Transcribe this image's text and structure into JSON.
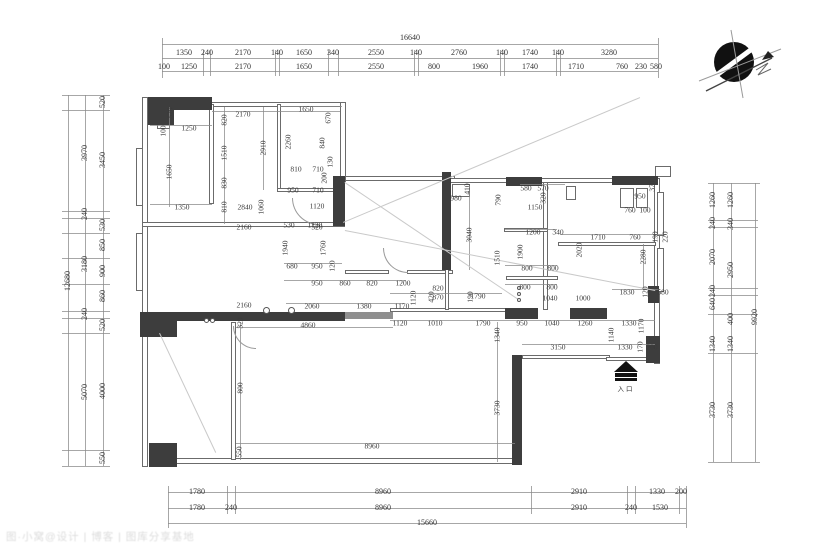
{
  "title": "户型平面图",
  "entrance": {
    "label": "入口"
  },
  "watermark": {
    "text": "图·小窝@设计 | 博客 | 图库分享基地"
  },
  "colors": {
    "wall_dark": "#3d3d3d",
    "wall_gray": "#8f8f8f",
    "line": "#8a8a8a",
    "text": "#3a3a3a",
    "compass": "#111111"
  },
  "icons": [
    "north-compass-icon",
    "entrance-arrow-icon"
  ],
  "exterior_dims": [
    [
      "16640",
      410,
      38,
      0
    ],
    [
      "1350",
      184,
      53,
      0
    ],
    [
      "240",
      207,
      53,
      0
    ],
    [
      "2170",
      243,
      53,
      0
    ],
    [
      "140",
      277,
      53,
      0
    ],
    [
      "1650",
      304,
      53,
      0
    ],
    [
      "340",
      333,
      53,
      0
    ],
    [
      "2550",
      376,
      53,
      0
    ],
    [
      "140",
      416,
      53,
      0
    ],
    [
      "2760",
      459,
      53,
      0
    ],
    [
      "140",
      502,
      53,
      0
    ],
    [
      "1740",
      530,
      53,
      0
    ],
    [
      "140",
      558,
      53,
      0
    ],
    [
      "3280",
      609,
      53,
      0
    ],
    [
      "100",
      164,
      67,
      0
    ],
    [
      "1250",
      189,
      67,
      0
    ],
    [
      "2170",
      243,
      67,
      0
    ],
    [
      "1650",
      304,
      67,
      0
    ],
    [
      "2550",
      376,
      67,
      0
    ],
    [
      "800",
      434,
      67,
      0
    ],
    [
      "1960",
      480,
      67,
      0
    ],
    [
      "1740",
      530,
      67,
      0
    ],
    [
      "1710",
      576,
      67,
      0
    ],
    [
      "760",
      622,
      67,
      0
    ],
    [
      "230",
      641,
      67,
      0
    ],
    [
      "580",
      656,
      67,
      0
    ],
    [
      "1780",
      197,
      492,
      0
    ],
    [
      "8960",
      383,
      492,
      0
    ],
    [
      "2910",
      579,
      492,
      0
    ],
    [
      "1330",
      657,
      492,
      0
    ],
    [
      "200",
      681,
      492,
      0
    ],
    [
      "1780",
      197,
      508,
      0
    ],
    [
      "240",
      231,
      508,
      0
    ],
    [
      "8960",
      383,
      508,
      0
    ],
    [
      "2910",
      579,
      508,
      0
    ],
    [
      "240",
      631,
      508,
      0
    ],
    [
      "1530",
      660,
      508,
      0
    ],
    [
      "15660",
      427,
      523,
      0
    ],
    [
      "12680",
      68,
      281,
      1
    ],
    [
      "3970",
      85,
      153,
      1
    ],
    [
      "240",
      85,
      214,
      1
    ],
    [
      "3180",
      85,
      264,
      1
    ],
    [
      "240",
      85,
      314,
      1
    ],
    [
      "5070",
      85,
      392,
      1
    ],
    [
      "520",
      103,
      102,
      1
    ],
    [
      "3450",
      103,
      160,
      1
    ],
    [
      "530",
      103,
      225,
      1
    ],
    [
      "850",
      103,
      245,
      1
    ],
    [
      "900",
      103,
      271,
      1
    ],
    [
      "860",
      103,
      296,
      1
    ],
    [
      "520",
      103,
      325,
      1
    ],
    [
      "4000",
      103,
      391,
      1
    ],
    [
      "550",
      103,
      458,
      1
    ],
    [
      "1260",
      713,
      200,
      1
    ],
    [
      "240",
      713,
      223,
      1
    ],
    [
      "2070",
      713,
      257,
      1
    ],
    [
      "240",
      713,
      291,
      1
    ],
    [
      "640",
      713,
      304,
      1
    ],
    [
      "1340",
      713,
      344,
      1
    ],
    [
      "3730",
      713,
      410,
      1
    ],
    [
      "1260",
      731,
      200,
      1
    ],
    [
      "340",
      731,
      224,
      1
    ],
    [
      "2950",
      731,
      270,
      1
    ],
    [
      "400",
      731,
      319,
      1
    ],
    [
      "1340",
      731,
      344,
      1
    ],
    [
      "3730",
      731,
      410,
      1
    ],
    [
      "9920",
      755,
      317,
      1
    ]
  ],
  "interior_dims": [
    [
      "520",
      170,
      113,
      1
    ],
    [
      "100",
      163,
      131,
      1
    ],
    [
      "1250",
      189,
      128,
      0
    ],
    [
      "1650",
      169,
      172,
      1
    ],
    [
      "1350",
      182,
      207,
      0
    ],
    [
      "2170",
      243,
      114,
      0
    ],
    [
      "820",
      224,
      120,
      1
    ],
    [
      "1510",
      224,
      153,
      1
    ],
    [
      "830",
      224,
      183,
      1
    ],
    [
      "810",
      224,
      207,
      1
    ],
    [
      "2910",
      263,
      148,
      1
    ],
    [
      "2840",
      245,
      207,
      0
    ],
    [
      "1060",
      261,
      207,
      1
    ],
    [
      "1650",
      306,
      109,
      0
    ],
    [
      "670",
      328,
      118,
      1
    ],
    [
      "2260",
      288,
      142,
      1
    ],
    [
      "840",
      322,
      143,
      1
    ],
    [
      "810",
      296,
      169,
      0
    ],
    [
      "710",
      318,
      169,
      0
    ],
    [
      "130",
      330,
      162,
      1
    ],
    [
      "200",
      324,
      178,
      1
    ],
    [
      "950",
      293,
      190,
      0
    ],
    [
      "710",
      318,
      190,
      0
    ],
    [
      "1120",
      317,
      206,
      0
    ],
    [
      "530",
      289,
      225,
      0
    ],
    [
      "1120",
      315,
      225,
      0
    ],
    [
      "2160",
      244,
      227,
      0
    ],
    [
      "520",
      317,
      227,
      0
    ],
    [
      "1940",
      285,
      248,
      1
    ],
    [
      "1760",
      323,
      248,
      1
    ],
    [
      "680",
      292,
      266,
      0
    ],
    [
      "950",
      317,
      266,
      0
    ],
    [
      "120",
      332,
      266,
      1
    ],
    [
      "950",
      317,
      283,
      0
    ],
    [
      "860",
      345,
      283,
      0
    ],
    [
      "820",
      372,
      283,
      0
    ],
    [
      "1200",
      403,
      283,
      0
    ],
    [
      "820",
      438,
      288,
      0
    ],
    [
      "870",
      438,
      297,
      0
    ],
    [
      "1120",
      413,
      298,
      1
    ],
    [
      "2060",
      312,
      306,
      0
    ],
    [
      "1380",
      364,
      306,
      0
    ],
    [
      "1170",
      402,
      306,
      0
    ],
    [
      "2160",
      244,
      305,
      0
    ],
    [
      "320",
      240,
      323,
      1
    ],
    [
      "4860",
      308,
      325,
      0
    ],
    [
      "800",
      240,
      388,
      1
    ],
    [
      "550",
      239,
      452,
      1
    ],
    [
      "8960",
      372,
      446,
      0
    ],
    [
      "980",
      456,
      198,
      0
    ],
    [
      "410",
      467,
      189,
      1
    ],
    [
      "3040",
      469,
      235,
      1
    ],
    [
      "790",
      498,
      200,
      1
    ],
    [
      "580",
      526,
      188,
      0
    ],
    [
      "570",
      543,
      188,
      0
    ],
    [
      "320",
      543,
      198,
      1
    ],
    [
      "1150",
      535,
      207,
      0
    ],
    [
      "1200",
      533,
      232,
      0
    ],
    [
      "340",
      558,
      232,
      0
    ],
    [
      "1900",
      520,
      252,
      1
    ],
    [
      "2020",
      579,
      250,
      1
    ],
    [
      "800",
      527,
      268,
      0
    ],
    [
      "800",
      553,
      268,
      0
    ],
    [
      "1510",
      497,
      258,
      1
    ],
    [
      "800",
      525,
      287,
      0
    ],
    [
      "800",
      552,
      287,
      0
    ],
    [
      "190",
      470,
      297,
      1
    ],
    [
      "420",
      431,
      297,
      1
    ],
    [
      "1790",
      478,
      296,
      0
    ],
    [
      "1040",
      550,
      298,
      0
    ],
    [
      "1000",
      583,
      298,
      0
    ],
    [
      "1710",
      598,
      237,
      0
    ],
    [
      "760",
      635,
      237,
      0
    ],
    [
      "190",
      655,
      237,
      1
    ],
    [
      "220",
      665,
      237,
      1
    ],
    [
      "950",
      640,
      196,
      0
    ],
    [
      "370",
      652,
      186,
      1
    ],
    [
      "760",
      630,
      210,
      0
    ],
    [
      "100",
      645,
      210,
      0
    ],
    [
      "2280",
      643,
      257,
      1
    ],
    [
      "1830",
      627,
      292,
      0
    ],
    [
      "120",
      645,
      292,
      1
    ],
    [
      "580",
      663,
      292,
      0
    ],
    [
      "950",
      522,
      323,
      0
    ],
    [
      "1040",
      552,
      323,
      0
    ],
    [
      "1260",
      585,
      323,
      0
    ],
    [
      "1330",
      629,
      323,
      0
    ],
    [
      "1170",
      641,
      326,
      1
    ],
    [
      "1140",
      611,
      335,
      1
    ],
    [
      "1120",
      400,
      323,
      0
    ],
    [
      "1010",
      435,
      323,
      0
    ],
    [
      "1790",
      483,
      323,
      0
    ],
    [
      "3150",
      558,
      347,
      0
    ],
    [
      "1330",
      625,
      347,
      0
    ],
    [
      "170",
      640,
      347,
      1
    ],
    [
      "200",
      652,
      347,
      0
    ],
    [
      "1340",
      497,
      335,
      1
    ],
    [
      "3730",
      497,
      408,
      1
    ]
  ]
}
